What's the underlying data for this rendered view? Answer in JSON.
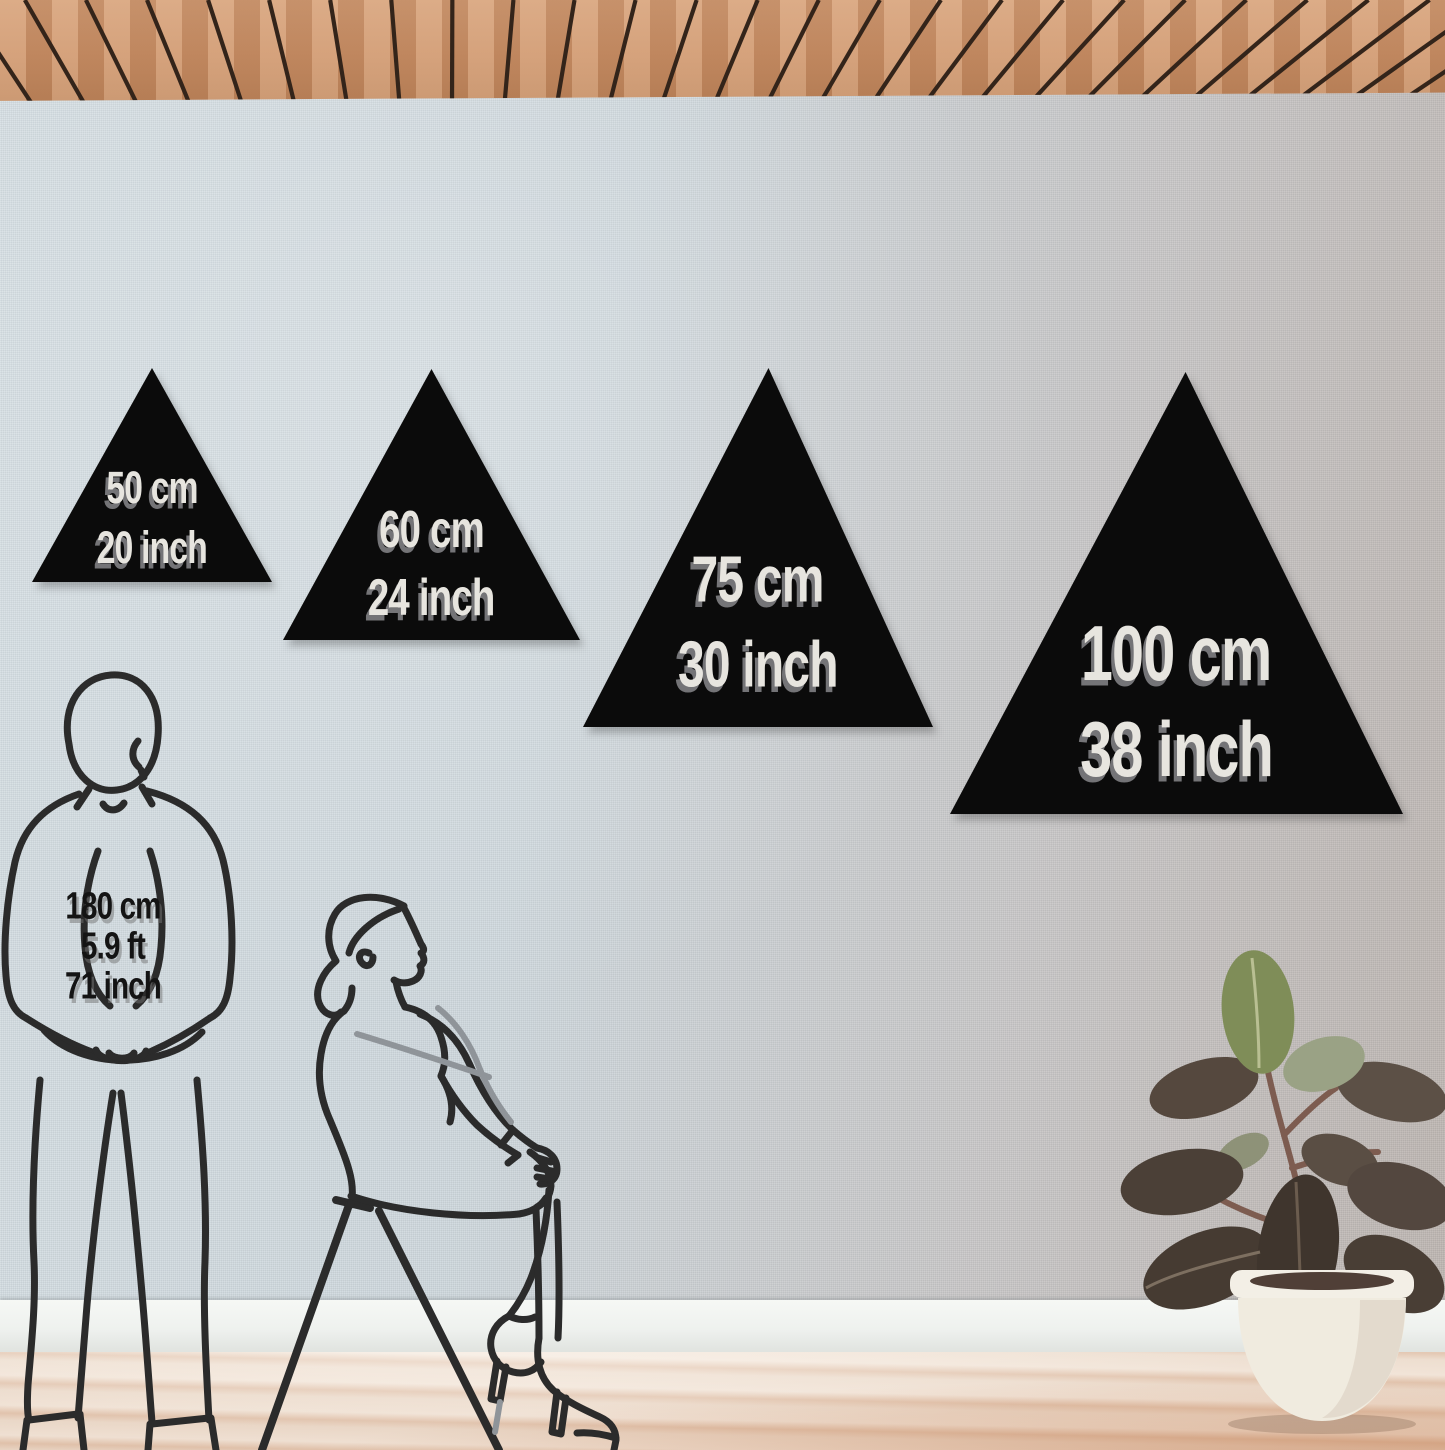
{
  "triangles": [
    {
      "cm_label": "50 cm",
      "inch_label": "20 inch"
    },
    {
      "cm_label": "60 cm",
      "inch_label": "24 inch"
    },
    {
      "cm_label": "75 cm",
      "inch_label": "30 inch"
    },
    {
      "cm_label": "100 cm",
      "inch_label": "38 inch"
    }
  ],
  "reference_person": {
    "height_cm": "180 cm",
    "height_ft": "5.9 ft",
    "height_inch": "71 inch"
  },
  "figures": {
    "man": "standing-man-line-art",
    "woman": "seated-woman-line-art",
    "plant": "rubber-plant-in-white-pot"
  },
  "colors": {
    "triangle_fill": "#0b0b0b",
    "triangle_text": "#e7e5df",
    "label_text": "#141414",
    "line_art": "#2b2b2b",
    "wall_left": "#d6dfe4",
    "wall_right": "#bdb5b0",
    "ceiling_wood": "#c98f66",
    "ceiling_gap": "#33241a",
    "floor_base": "#eedfd1",
    "baseboard": "#eef1ee",
    "pot": "#f1ece0",
    "leaf_dark": "#4b4037",
    "leaf_green": "#7f8d58"
  }
}
